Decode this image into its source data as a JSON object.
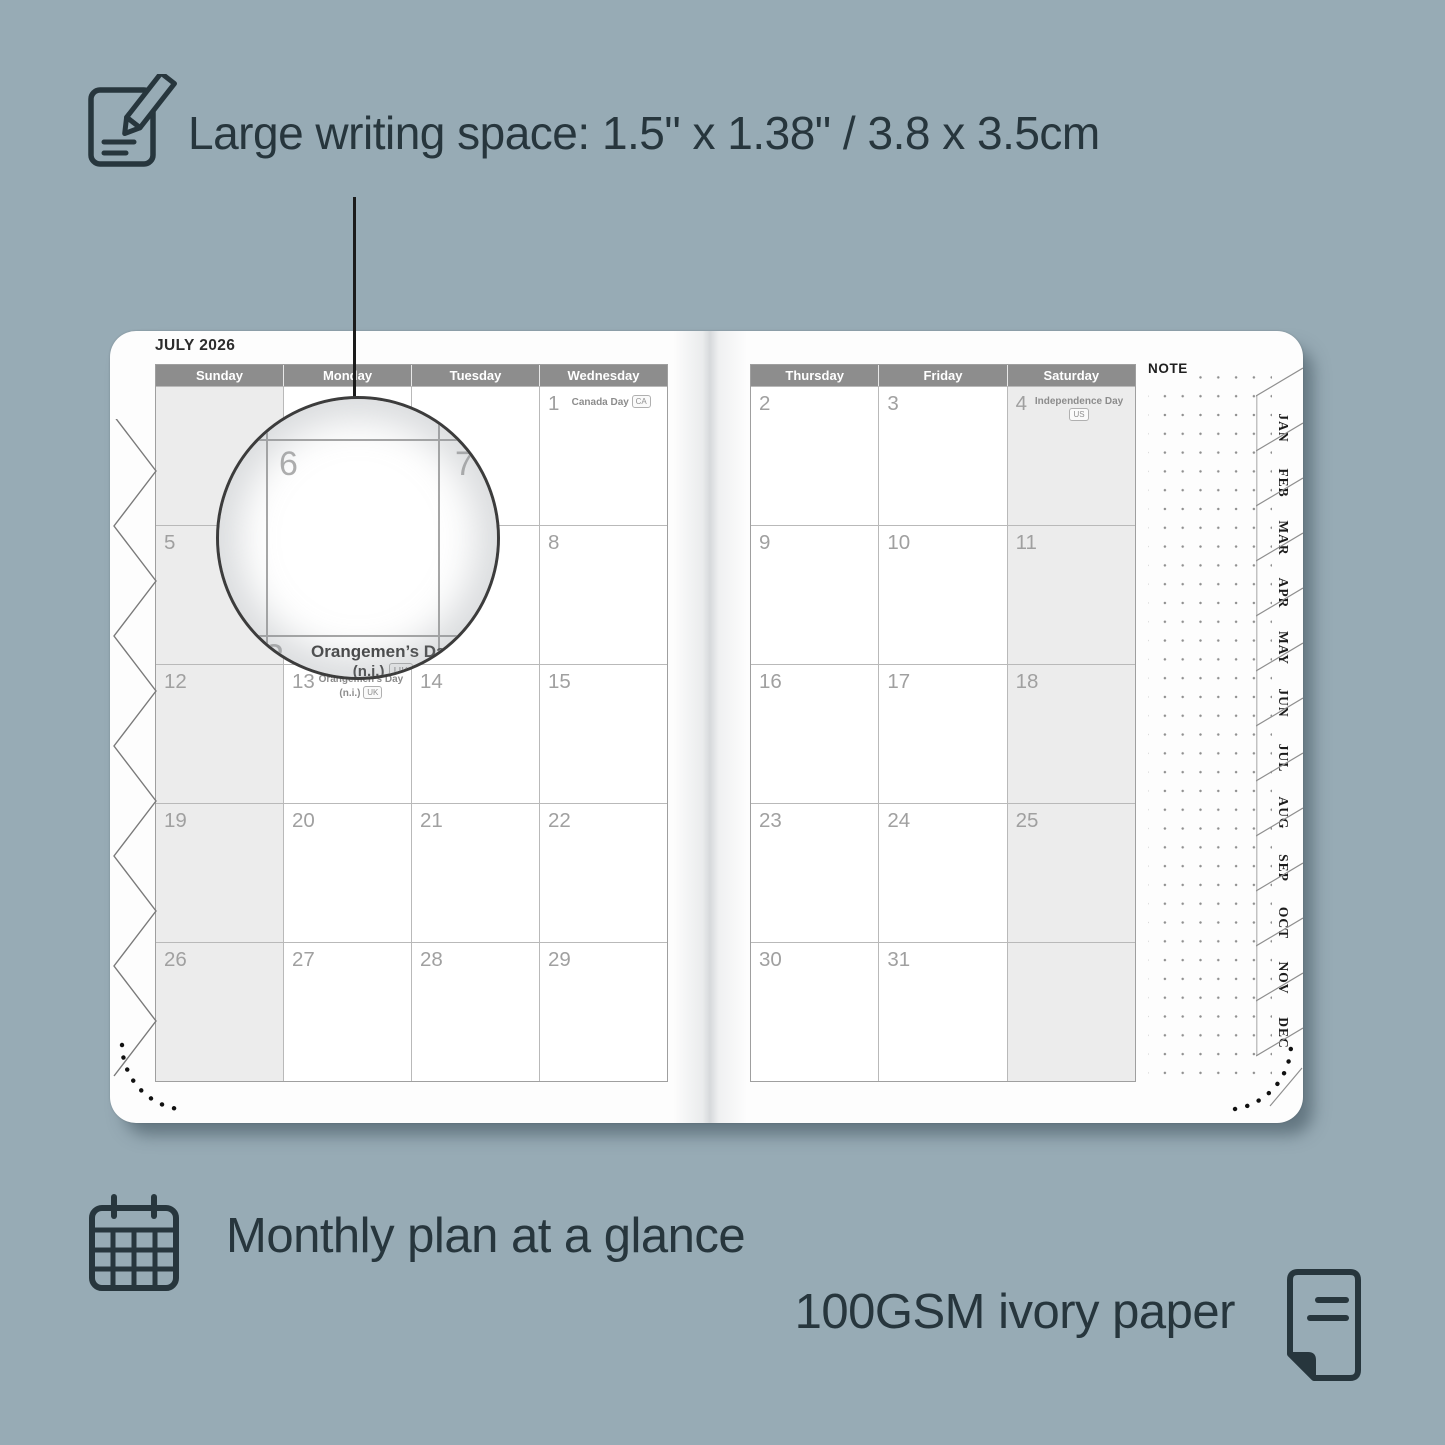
{
  "colors": {
    "background": "#97abb5",
    "caption_text": "#27363d",
    "header_bar": "#8d8d8d",
    "shaded_cell": "#ececec",
    "date_text": "#a0a0a0"
  },
  "captions": {
    "writing_space": "Large writing space: 1.5\" x 1.38\" / 3.8 x 3.5cm",
    "monthly_plan": "Monthly plan at a glance",
    "paper": "100GSM ivory paper"
  },
  "planner": {
    "title": "JULY 2026",
    "note_label": "NOTE",
    "left_day_headers": [
      "Sunday",
      "Monday",
      "Tuesday",
      "Wednesday"
    ],
    "right_day_headers": [
      "Thursday",
      "Friday",
      "Saturday"
    ],
    "left_weeks": [
      [
        {
          "d": ""
        },
        {
          "d": ""
        },
        {
          "d": ""
        },
        {
          "d": "1",
          "h": "Canada Day",
          "b": "CA"
        }
      ],
      [
        {
          "d": "5"
        },
        {
          "d": "6"
        },
        {
          "d": "7"
        },
        {
          "d": "8"
        }
      ],
      [
        {
          "d": "12"
        },
        {
          "d": "13",
          "h": "Orangemen’s Day (n.i.)",
          "b": "UK"
        },
        {
          "d": "14"
        },
        {
          "d": "15"
        }
      ],
      [
        {
          "d": "19"
        },
        {
          "d": "20"
        },
        {
          "d": "21"
        },
        {
          "d": "22"
        }
      ],
      [
        {
          "d": "26"
        },
        {
          "d": "27"
        },
        {
          "d": "28"
        },
        {
          "d": "29"
        }
      ]
    ],
    "right_weeks": [
      [
        {
          "d": "2"
        },
        {
          "d": "3"
        },
        {
          "d": "4",
          "h": "Independence Day",
          "b": "US"
        }
      ],
      [
        {
          "d": "9"
        },
        {
          "d": "10"
        },
        {
          "d": "11"
        }
      ],
      [
        {
          "d": "16"
        },
        {
          "d": "17"
        },
        {
          "d": "18"
        }
      ],
      [
        {
          "d": "23"
        },
        {
          "d": "24"
        },
        {
          "d": "25"
        }
      ],
      [
        {
          "d": "30"
        },
        {
          "d": "31"
        },
        {
          "d": ""
        }
      ]
    ],
    "month_tabs": [
      "JAN",
      "FEB",
      "MAR",
      "APR",
      "MAY",
      "JUN",
      "JUL",
      "AUG",
      "SEP",
      "OCT",
      "NOV",
      "DEC"
    ],
    "magnifier": {
      "top_left_date": "6",
      "top_right_date": "7",
      "bottom_date": "13",
      "holiday_line1": "Orangemen’s Day",
      "holiday_line2": "(n.i.)",
      "badge": "UK"
    }
  }
}
